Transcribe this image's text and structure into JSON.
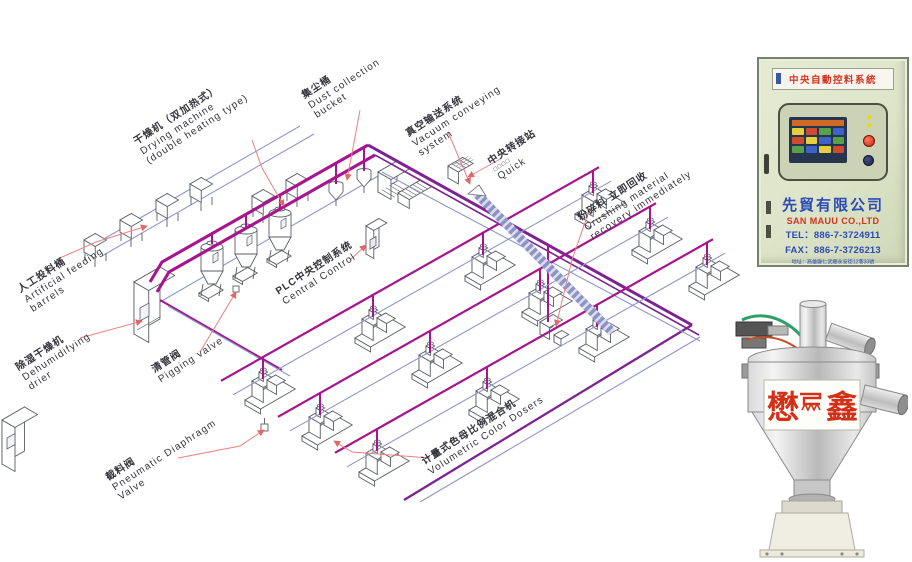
{
  "diagram": {
    "labels": [
      {
        "id": "artificial-feeding",
        "lines": [
          "人工投料桶",
          "Artificial feeding",
          "barrels"
        ]
      },
      {
        "id": "drying-machine",
        "lines": [
          "干燥机（双加热式）",
          "Drying machine",
          "(double heating type)"
        ]
      },
      {
        "id": "dust-collection",
        "lines": [
          "集尘桶",
          "Dust collection",
          "bucket"
        ]
      },
      {
        "id": "vacuum-conveying",
        "lines": [
          "真空输送系统",
          "Vacuum conveying",
          "system"
        ]
      },
      {
        "id": "transfer-station",
        "lines": [
          "中央转接站",
          "□□□□",
          "Quick"
        ]
      },
      {
        "id": "crushing-recovery",
        "lines": [
          "粉碎料 立即回收",
          "Crushing material",
          "recovery immediately"
        ]
      },
      {
        "id": "plc-control",
        "lines": [
          "PLC中央控制系统",
          "Central Control"
        ]
      },
      {
        "id": "dehumidifying-drier",
        "lines": [
          "除湿干燥机",
          "Dehumidifying",
          "drier"
        ]
      },
      {
        "id": "pigging-valve",
        "lines": [
          "清管阀",
          "Pigging valve"
        ]
      },
      {
        "id": "pneumatic-diaphragm-valve",
        "lines": [
          "截料阀",
          "Pneumatic Diaphragm",
          "Valve"
        ]
      },
      {
        "id": "volumetric-color-dosers",
        "lines": [
          "计量式色母比例混合机",
          "Volumetric Color Dosers"
        ]
      }
    ],
    "pipe_colors": {
      "magenta": "#a8138e",
      "purple": "#7d2391",
      "blue": "#9096c8",
      "band": "#8d93c4",
      "leader": "#ee8080",
      "machine_stroke": "#5a5e66"
    }
  },
  "control_panel": {
    "header": "中央自動控料系統",
    "company_zh": "先貿有限公司",
    "company_en": "SAN MAUU CO.,LTD",
    "tel": "TEL：886-7-3724911",
    "fax": "FAX：886-7-3726213",
    "address": "地址：高雄縣仁武鄉永安街12巷33號",
    "colors": {
      "cabinet": "#dde4c9",
      "header_text": "#d4321e",
      "company_zh": "#2b4bb5",
      "company_en": "#d4321e",
      "contact": "#2b4bb5"
    }
  },
  "hopper_photo": {
    "brand": "懋鑫",
    "brand_left": "懋",
    "brand_right": "鑫",
    "logo": "maoxin-zigzag-logo",
    "brand_color": "#d43018"
  }
}
